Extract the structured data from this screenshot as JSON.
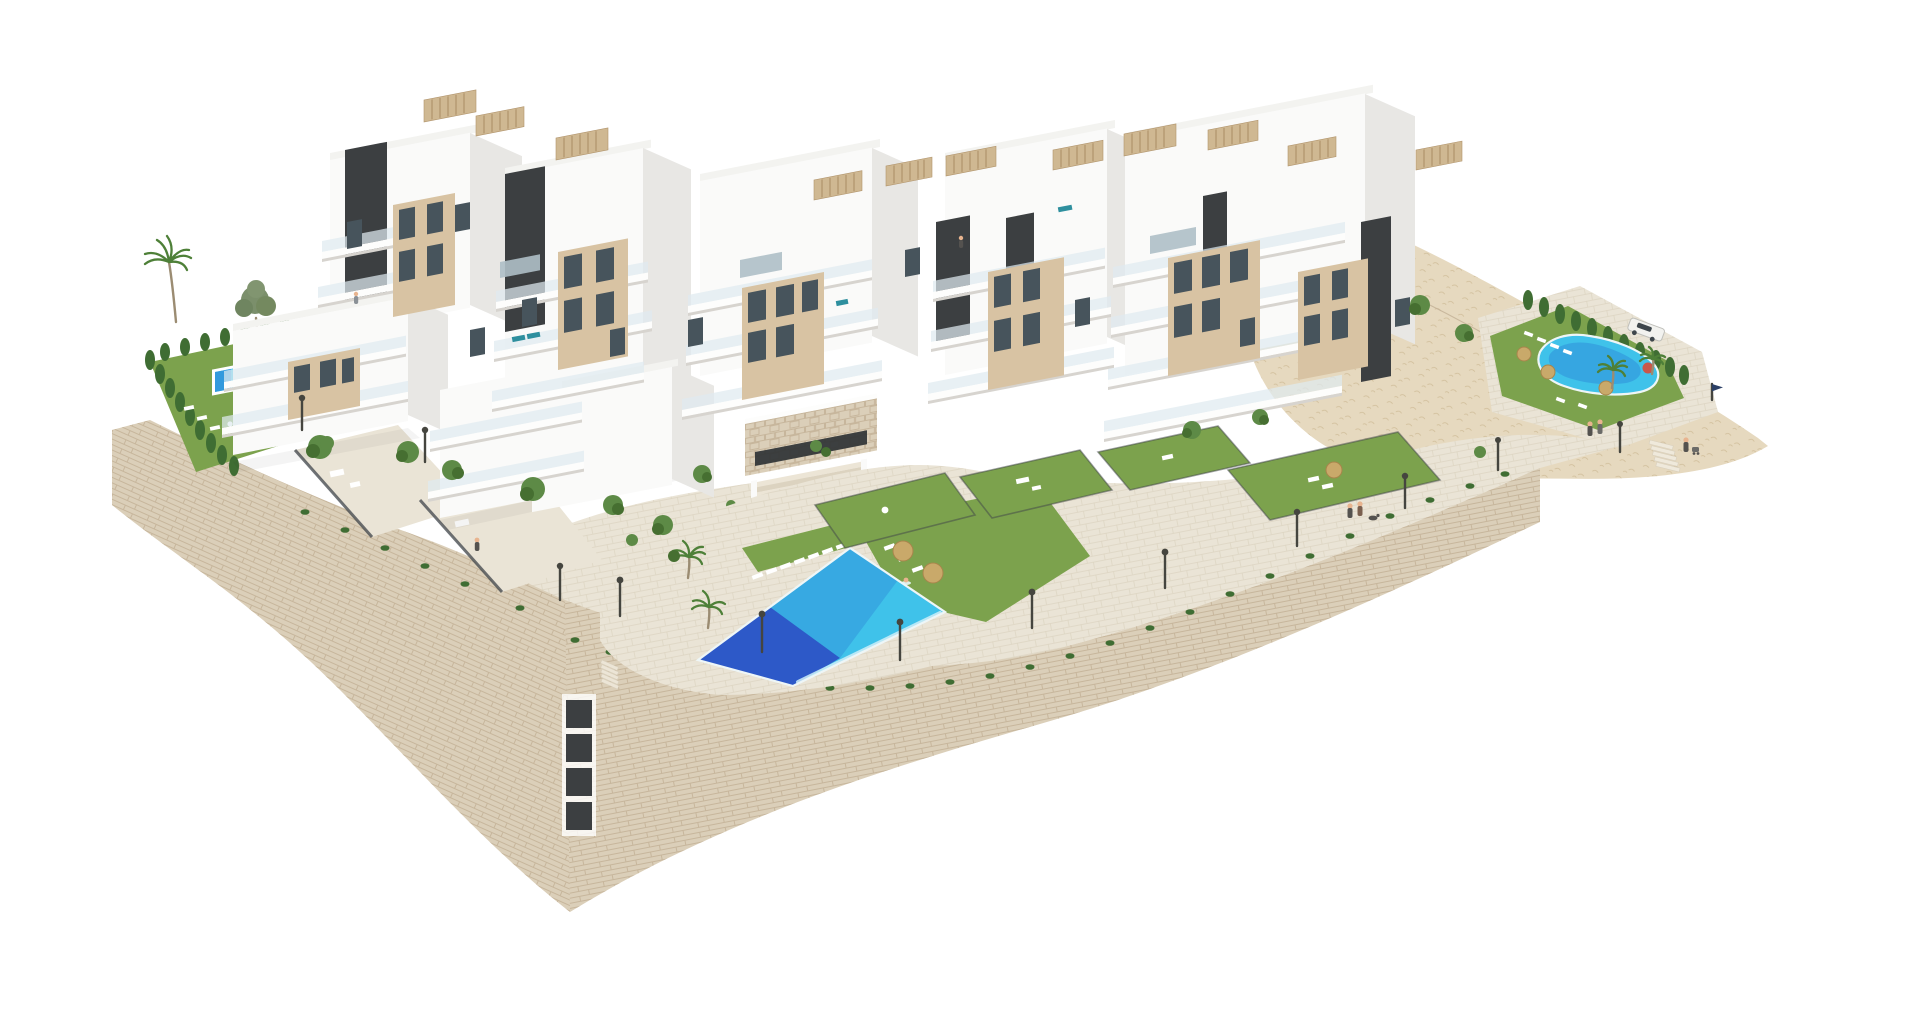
{
  "scene": {
    "type": "3d-architectural-render",
    "view": "aerial-isometric",
    "description": "Aerial 3D rendering of a modern hillside residential complex: stepped white apartment buildings with beige accents, dark stair cores and rooftop slat pergolas, terraced private gardens, three swimming pools, curved stone retaining walls, a paved promenade with street lamps and a rocky hillside with a parked white car.",
    "background": "#ffffff",
    "buildings": {
      "clusters": 6,
      "style": "modern white volumes, beige recessed window walls, glass balconies, dark vertical cores, flat roofs with wood-slat pergolas",
      "max_floors": 5
    },
    "pools": [
      {
        "name": "main-pool",
        "shape": "rectangular",
        "location": "center",
        "features": [
          "sun loungers",
          "straw parasols",
          "infinity edge",
          "swimmer"
        ]
      },
      {
        "name": "left-garden-pool",
        "shape": "rectangular",
        "location": "left garden",
        "features": [
          "sun loungers",
          "hedge enclosure",
          "palm tree"
        ]
      },
      {
        "name": "right-pool",
        "shape": "freeform",
        "location": "right terrace",
        "features": [
          "sun loungers",
          "parasols",
          "cypress hedge",
          "palm trees"
        ]
      }
    ],
    "landscape": [
      "curved stone retaining wall",
      "paved promenade",
      "rocky hillside",
      "private lawns",
      "cypress hedges",
      "palm trees",
      "ornamental trees",
      "trailing plants on wall edge"
    ],
    "objects": {
      "street_lamps": 12,
      "rooftop_pergolas": 11,
      "vehicles": [
        {
          "name": "white-car",
          "location": "right terrace near pool"
        }
      ],
      "people": "small figures: swimmers, pedestrians with dog and stroller, person on roof terrace",
      "furniture": [
        "white sun loungers",
        "outdoor sofas",
        "dining sets",
        "teal loungers"
      ]
    }
  },
  "colors": {
    "background": "#ffffff",
    "building_white": "#fafaf9",
    "building_shade": "#e8e7e4",
    "roof_light": "#f3f3f0",
    "slab_white": "#fdfdfc",
    "slab_shadow": "#d7d4cf",
    "balcony_glass": "#dfeaf0",
    "accent_beige": "#d8c3a3",
    "core_dark": "#3c3f41",
    "window_glass": "#47545c",
    "window_light": "#aebfc7",
    "stone_wall": "#dbcfb9",
    "stone_dark": "#cfc1a8",
    "stone_line": "#c3b296",
    "pavement": "#eae4d6",
    "paver_line": "#d8cfbc",
    "hillside": "#e6d9bf",
    "hill_dot": "#c9b58f",
    "lawn": "#7ca24d",
    "lawn_dark": "#64913e",
    "hedge": "#3f6d33",
    "tree": "#5d8a46",
    "tree_dark": "#466f31",
    "palm": "#4e8038",
    "trunk": "#9b8c72",
    "pool_bright": "#3fc2ea",
    "pool_mid": "#2f8fd9",
    "pool_deep": "#2b50c4",
    "pool_foam": "#cfeef8",
    "pool_rim": "#eef6f7",
    "parasol": "#c9a96a",
    "parasol_dark": "#a8854b",
    "pergola": "#cfb892",
    "pergola_slat": "#b1946c",
    "lamp": "#45453f",
    "people": "#54524f",
    "teal_furniture": "#2e8f9e",
    "car_white": "#f2f2ef",
    "car_glass": "#3e464c",
    "flag_navy": "#2b3f66",
    "red_parasol": "#c9574a",
    "fence": "#3f4449"
  }
}
